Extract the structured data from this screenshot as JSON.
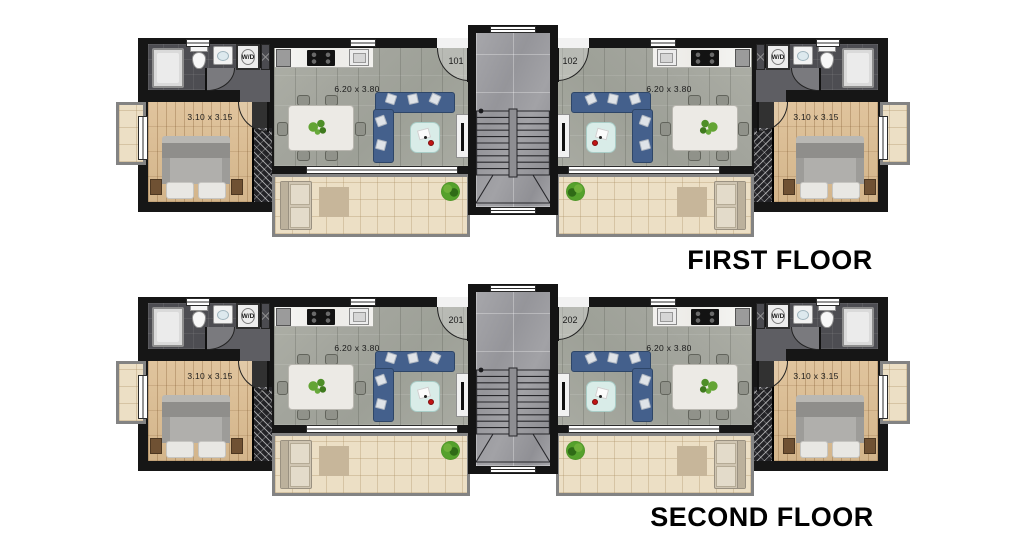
{
  "floors": [
    {
      "title": "FIRST FLOOR",
      "units": [
        {
          "number": "101",
          "living_dim": "6.20 x 3.80",
          "bedroom_dim": "3.10 x 3.15",
          "wd": "W/D"
        },
        {
          "number": "102",
          "living_dim": "6.20 x 3.80",
          "bedroom_dim": "3.10 x 3.15",
          "wd": "W/D"
        }
      ]
    },
    {
      "title": "SECOND FLOOR",
      "units": [
        {
          "number": "201",
          "living_dim": "6.20 x 3.80",
          "bedroom_dim": "3.10 x 3.15",
          "wd": "W/D"
        },
        {
          "number": "202",
          "living_dim": "6.20 x 3.80",
          "bedroom_dim": "3.10 x 3.15",
          "wd": "W/D"
        }
      ]
    }
  ],
  "colors": {
    "wall": "#161616",
    "living_tile": "#a5a79f",
    "lobby_marble": "#9c9da0",
    "bedroom_wood": "#d9bd96",
    "balcony_tile": "#ecdfc5",
    "bathroom_tile": "#4d4d52",
    "sofa_blue": "#44608c",
    "coffee_table_teal": "#d9ece8",
    "accent_red": "#c11414",
    "plant_green": "#55a12c",
    "background": "#ffffff"
  }
}
